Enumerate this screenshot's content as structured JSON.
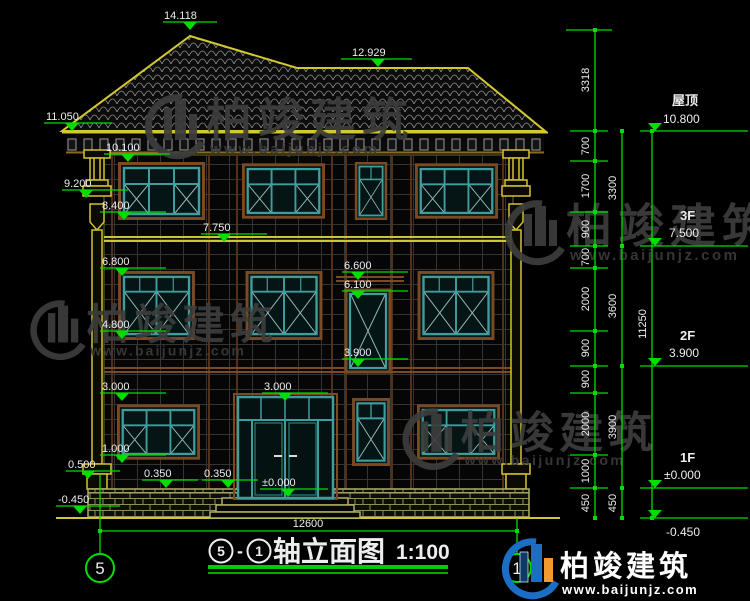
{
  "drawing_title": {
    "axis_from": "5",
    "axis_to": "1",
    "dash": "-",
    "name": "轴立面图",
    "scale": "1:100"
  },
  "axis_bubbles": {
    "left": "5",
    "right": "1"
  },
  "levels_left": [
    "14.118",
    "12.929",
    "11.050",
    "10.100",
    "9.200",
    "8.400",
    "7.750",
    "6.800",
    "6.600",
    "6.100",
    "4.800",
    "3.900",
    "3.000",
    "3.000",
    "1.000",
    "0.500",
    "0.350",
    "0.350",
    "±0.000",
    "-0.450"
  ],
  "levels_right": [
    {
      "name": "屋顶",
      "value": "10.800"
    },
    {
      "name": "3F",
      "value": "7.500"
    },
    {
      "name": "2F",
      "value": "3.900"
    },
    {
      "name": "1F",
      "value": "±0.000"
    },
    {
      "name": "",
      "value": "-0.450"
    }
  ],
  "chains": {
    "inner": [
      "3318",
      "700",
      "1700",
      "900",
      "700",
      "2000",
      "900",
      "900",
      "2000",
      "1000",
      "450"
    ],
    "middle": [
      "3300",
      "3600",
      "3900",
      "450"
    ],
    "outer": [
      "11250"
    ]
  },
  "bottom_width": "12600",
  "watermark": {
    "brand": "柏竣建筑",
    "url": "www.baijunjz.com"
  },
  "colors": {
    "dim_green": "#00dd00",
    "cad_yellow": "#d4c832",
    "trim_brown": "#7a4a24",
    "frame_teal": "#3f9d9d",
    "text_white": "#ededed",
    "logo_blue": "#1a6fc4",
    "logo_orange": "#f29a2e",
    "watermark_gray": "#3d3d3d"
  }
}
